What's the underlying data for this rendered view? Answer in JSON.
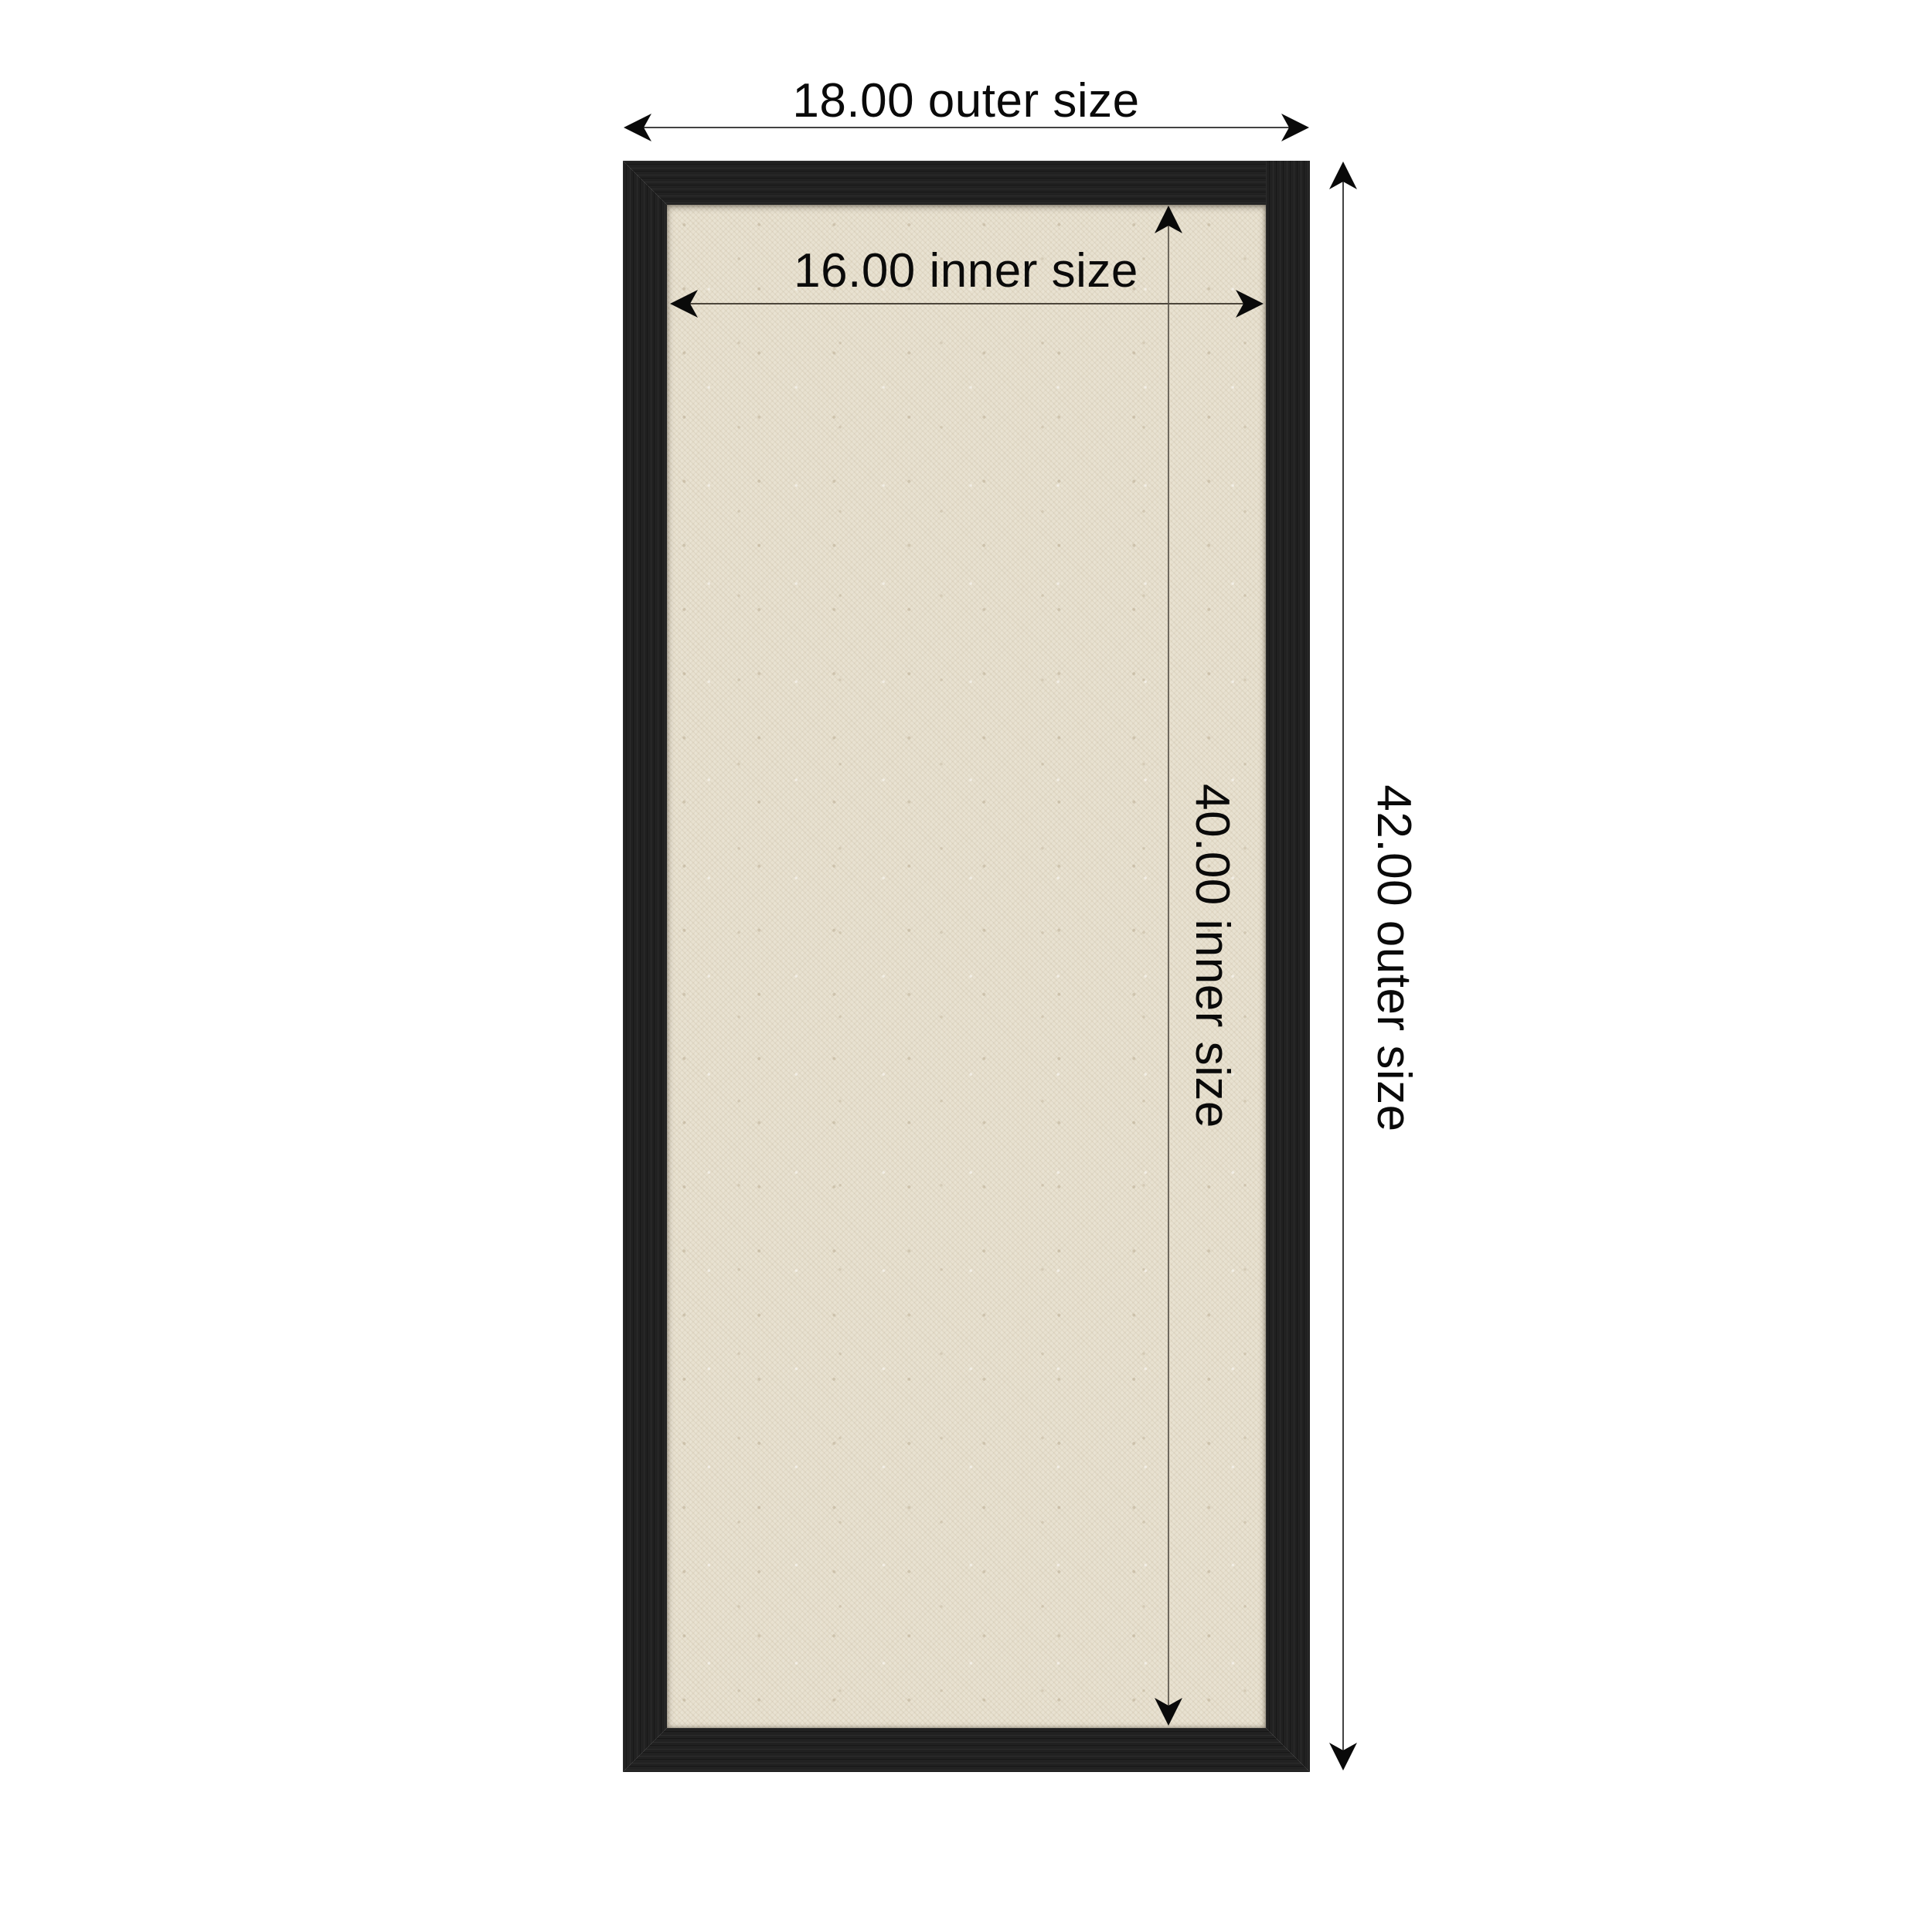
{
  "page": {
    "background_color": "#ffffff",
    "annotation_color": "#0a0a0a"
  },
  "board": {
    "frame_color": "#212121",
    "canvas_color": "#e8e1d0"
  },
  "dimensions": {
    "outer_width": {
      "label": "18.00 outer size"
    },
    "inner_width": {
      "label": "16.00 inner size"
    },
    "inner_height": {
      "label": "40.00 inner size"
    },
    "outer_height": {
      "label": "42.00 outer size"
    }
  }
}
